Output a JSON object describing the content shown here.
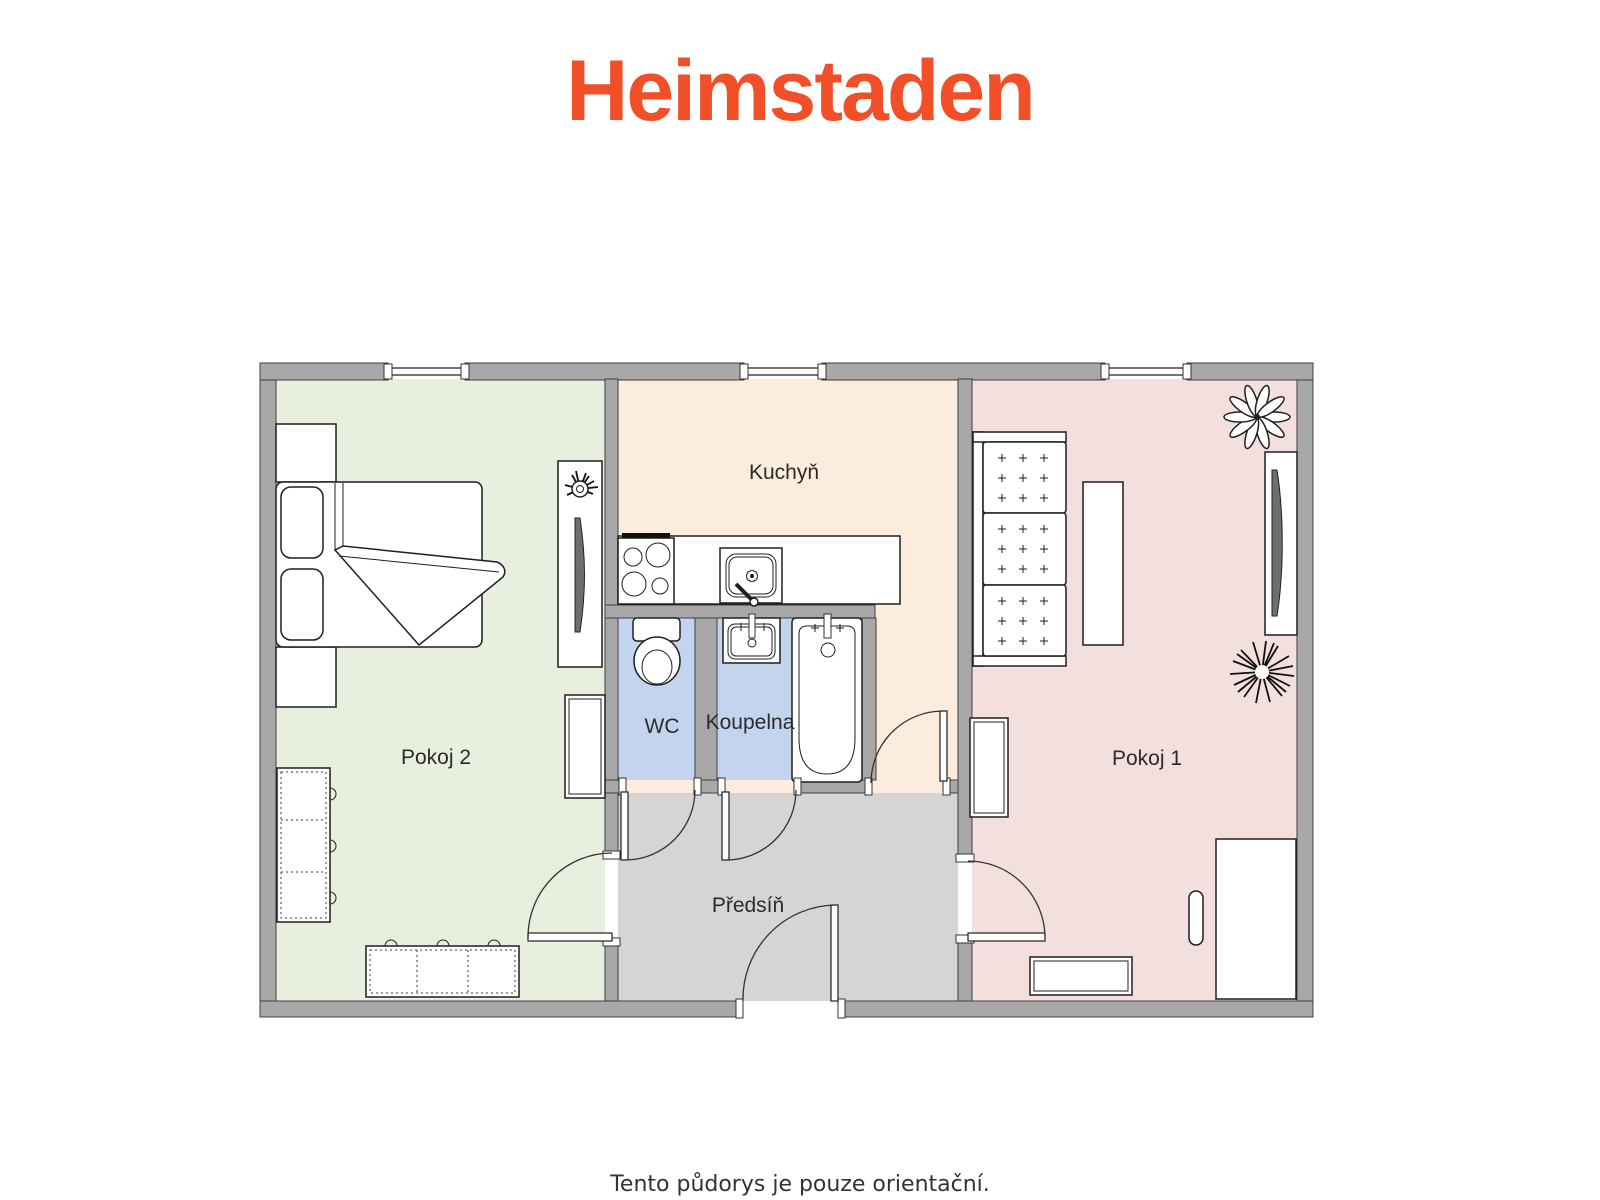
{
  "logo": {
    "text": "Heimstaden"
  },
  "rooms": {
    "pokoj2": {
      "label": "Pokoj 2",
      "color": "#e9efdf"
    },
    "kuchyn": {
      "label": "Kuchyň",
      "color": "#fcecdd"
    },
    "pokoj1": {
      "label": "Pokoj 1",
      "color": "#f3dfde"
    },
    "wc": {
      "label": "WC",
      "color": "#c3d4ee"
    },
    "koupelna": {
      "label": "Koupelna",
      "color": "#c3d4ee"
    },
    "predsin": {
      "label": "Předsíň",
      "color": "#d5d5d5"
    }
  },
  "footer": {
    "note": "Tento půdorys je pouze orientační."
  },
  "colors": {
    "brand_orange": "#f04f28",
    "wall_gray": "#a8a8a8",
    "label_text": "#2b2b2b",
    "footer_text": "#333333"
  }
}
